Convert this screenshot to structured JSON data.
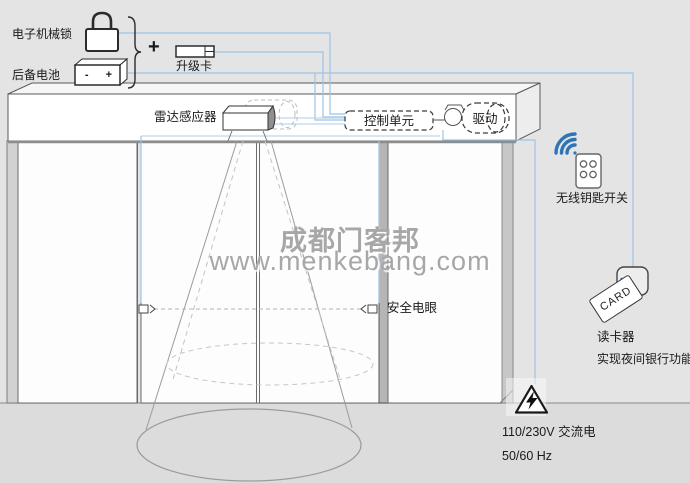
{
  "labels": {
    "electronic_lock": "电子机械锁",
    "backup_battery": "后备电池",
    "battery_terminals": "- +",
    "plus_sign": "+",
    "upgrade_card": "升级卡",
    "radar_sensor": "雷达感应器",
    "control_unit": "控制单元",
    "drive": "驱动",
    "wireless_key_switch": "无线钥匙开关",
    "safety_photocell": "安全电眼",
    "card_reader": "读卡器",
    "card_reader_note": "实现夜间银行功能",
    "card_text": "CARD",
    "power_voltage": "110/230V 交流电",
    "power_frequency": "50/60 Hz"
  },
  "watermark": {
    "line1": "成都门客邦",
    "line2": "www.menkebang.com"
  },
  "icons": {
    "padlock-icon": "padlock outline above electronic lock wire",
    "battery-icon": "3d battery block with - + terminals",
    "brace-icon": "curly brace joining lock and battery to plus",
    "upgrade-card-icon": "flat key card",
    "radar-sensor-icon": "3d sensor box on door header",
    "control-unit-box": "dashed rounded rectangle",
    "drive-motor-icon": "dashed motor capsule with pulley",
    "remote-control-icon": "handheld remote with 4 buttons",
    "wifi-arcs-icon": "blue radio arcs",
    "photocell-icon": "small emitter/receiver squares with dashed beam",
    "card-reader-box": "rounded square with contactless arcs",
    "contactless-card-icon": "tilted CARD badge",
    "hazard-triangle-icon": "triangle with lightning bolt",
    "radar-cone": "detection cone with floor ellipse"
  },
  "colors": {
    "background": "#e4e4e4",
    "floor": "#dcdcdc",
    "panel_white": "#fdfdfd",
    "outline_gray": "#5a5a5a",
    "wire_blue": "#9dc3e6",
    "icon_blue": "#2e75b6",
    "watermark_gray": "#a7a7a7"
  }
}
